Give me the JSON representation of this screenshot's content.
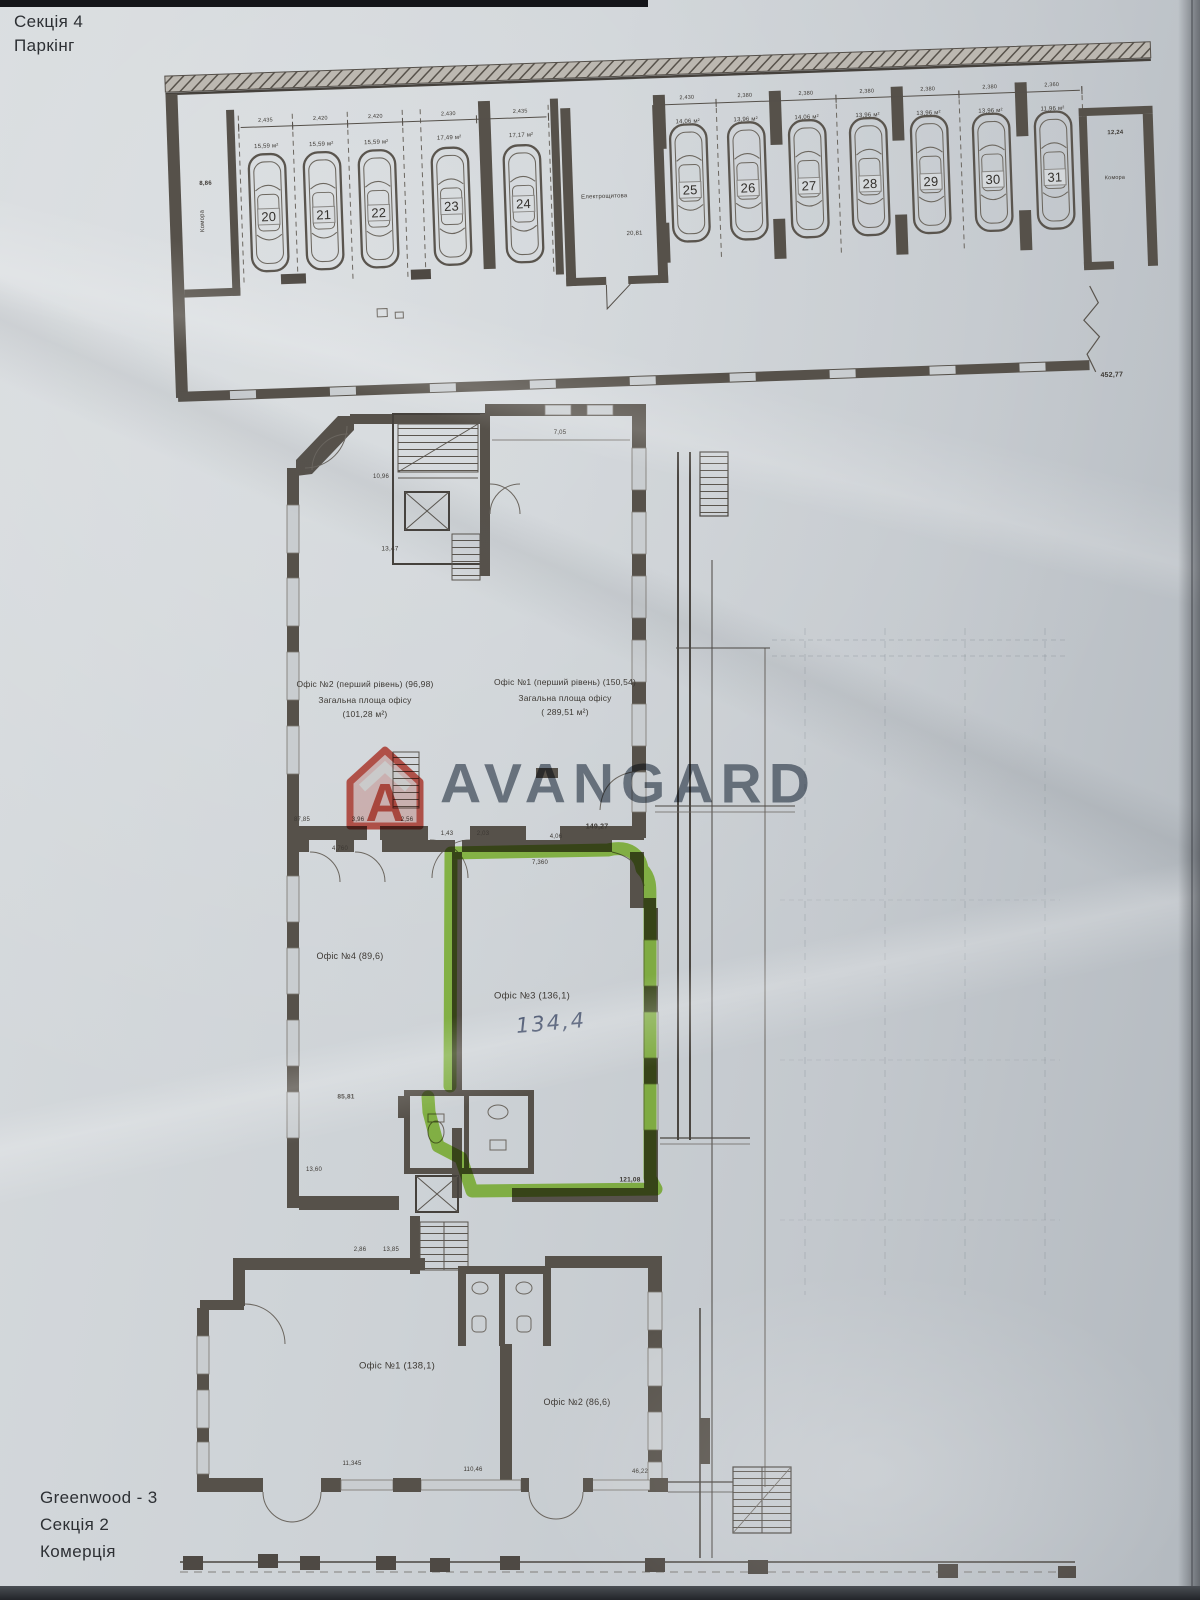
{
  "header": {
    "project_cutoff": "Greenwood - 3",
    "section": "Секція 4",
    "zone": "Паркінг"
  },
  "footer": {
    "project": "Greenwood - 3",
    "section": "Секція 2",
    "zone": "Комерція"
  },
  "watermark": {
    "brand": "AVANGARD",
    "logo_letter": "A",
    "brand_color": "#6a7684",
    "logo_color": "#cd4437"
  },
  "photo": {
    "highlight_color": "#8ccc2a",
    "paper_tone": "#ccd1d5"
  },
  "parking": {
    "left_stalls": [
      {
        "number": "20",
        "area": "15,59 м²",
        "width": "2,435"
      },
      {
        "number": "21",
        "area": "15,59 м²",
        "width": "2,420"
      },
      {
        "number": "22",
        "area": "15,59 м²",
        "width": "2,420"
      },
      {
        "number": "23",
        "area": "17,49 м²",
        "width": "2,430"
      },
      {
        "number": "24",
        "area": "17,17 м²",
        "width": "2,435"
      }
    ],
    "right_stalls": [
      {
        "number": "25",
        "area": "14,06 м²",
        "width": "2,430"
      },
      {
        "number": "26",
        "area": "13,96 м²",
        "width": "2,380"
      },
      {
        "number": "27",
        "area": "14,06 м²",
        "width": "2,380"
      },
      {
        "number": "28",
        "area": "13,96 м²",
        "width": "2,380"
      },
      {
        "number": "29",
        "area": "13,96 м²",
        "width": "2,380"
      },
      {
        "number": "30",
        "area": "13,96 м²",
        "width": "2,380"
      },
      {
        "number": "31",
        "area": "11,96 м²",
        "width": "2,360"
      }
    ],
    "storage_left_label": "Комора",
    "storage_left_area": "8,86",
    "electrical_label": "Електрощитова",
    "electrical_area": "20,81",
    "storage_right_label": "Комора",
    "storage_right_area": "12,24",
    "total_length": "452,77"
  },
  "upper": {
    "office2_title": "Офіс №2 (перший рівень) (96,98)",
    "office2_sub": "Загальна площа офісу",
    "office2_area": "(101,28 м²)",
    "office1_title": "Офіс №1 (перший рівень) (150,54)",
    "office1_sub": "Загальна площа офісу",
    "office1_area": "( 289,51 м²)",
    "dims": {
      "stair": "10,96",
      "left_wall": "13,47",
      "top_right": "7,05",
      "d1": "87,85",
      "d2": "3,96",
      "d3": "2,56",
      "d4": "2,03",
      "d5": "1,43",
      "d6": "4,06",
      "bottom_total": "149,27"
    }
  },
  "middle": {
    "office4_label": "Офіс №4 (89,6)",
    "office3_label": "Офіс №3 (136,1)",
    "office3_handwritten": "134,4",
    "dims": {
      "top_left": "4,760",
      "top_mid": "7,360",
      "left_bottom": "85,81",
      "bottom_right": "121,08",
      "left_small": "13,60"
    }
  },
  "lower": {
    "office1_label": "Офіс №1 (138,1)",
    "office2_label": "Офіс №2 (86,6)",
    "dims": {
      "top_a": "2,86",
      "top_b": "13,85",
      "bottom_a": "11,345",
      "bottom_b": "110,46",
      "bottom_c": "46,22"
    }
  }
}
